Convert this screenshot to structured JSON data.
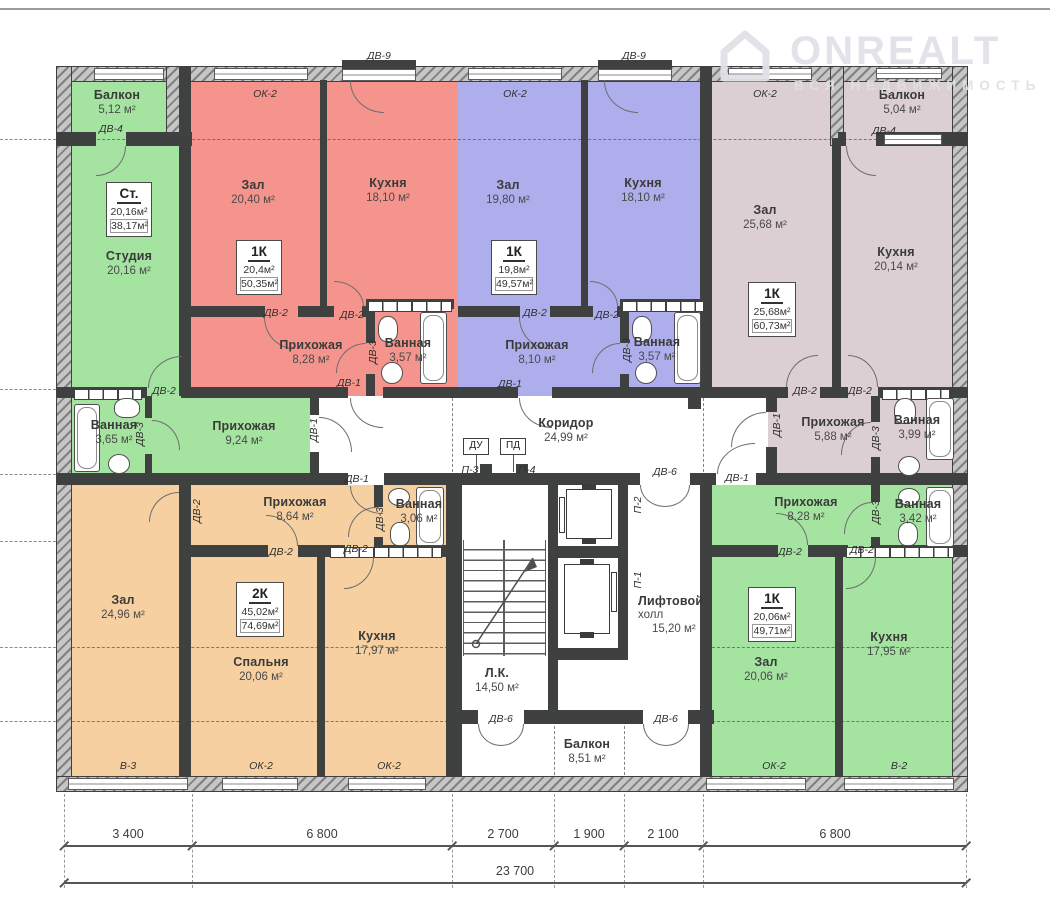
{
  "watermark": {
    "brand": "ONREALT",
    "tagline": "ВСЯ НЕДВИЖИМОСТЬ"
  },
  "legend": {
    "dv1": "ДВ-1",
    "dv2": "ДВ-2",
    "dv3": "ДВ-3",
    "dv4": "ДВ-4",
    "dv6": "ДВ-6",
    "dv9": "ДВ-9",
    "ok2": "ОК-2",
    "v2": "В-2",
    "v3": "В-3",
    "p1": "П-1",
    "p2": "П-2",
    "p3": "П-3",
    "p4": "П-4",
    "du": "ДУ",
    "pd": "ПД"
  },
  "apartments": {
    "studio": {
      "badge": {
        "type": "Ст.",
        "living": "20,16м²",
        "total": "38,17м²"
      },
      "balcony": {
        "name": "Балкон",
        "area": "5,12 м²"
      },
      "main": {
        "name": "Студия",
        "area": "20,16 м²"
      },
      "hall": {
        "name": "Прихожая",
        "area": "9,24 м²"
      },
      "bath": {
        "name": "Ванная",
        "area": "3,65 м²"
      }
    },
    "red1k": {
      "badge": {
        "type": "1К",
        "living": "20,4м²",
        "total": "50,35м²"
      },
      "zal": {
        "name": "Зал",
        "area": "20,40 м²"
      },
      "kitchen": {
        "name": "Кухня",
        "area": "18,10 м²"
      },
      "hall": {
        "name": "Прихожая",
        "area": "8,28 м²"
      },
      "bath": {
        "name": "Ванная",
        "area": "3,57 м²"
      }
    },
    "blue1k": {
      "badge": {
        "type": "1К",
        "living": "19,8м²",
        "total": "49,57м²"
      },
      "zal": {
        "name": "Зал",
        "area": "19,80 м²"
      },
      "kitchen": {
        "name": "Кухня",
        "area": "18,10 м²"
      },
      "hall": {
        "name": "Прихожая",
        "area": "8,10 м²"
      },
      "bath": {
        "name": "Ванная",
        "area": "3,57 м²"
      }
    },
    "mauve1k": {
      "badge": {
        "type": "1К",
        "living": "25,68м²",
        "total": "60,73м²"
      },
      "balcony": {
        "name": "Балкон",
        "area": "5,04 м²"
      },
      "zal": {
        "name": "Зал",
        "area": "25,68 м²"
      },
      "kitchen": {
        "name": "Кухня",
        "area": "20,14 м²"
      },
      "hall": {
        "name": "Прихожая",
        "area": "5,88 м²"
      },
      "bath": {
        "name": "Ванная",
        "area": "3,99 м²"
      }
    },
    "orange2k": {
      "badge": {
        "type": "2К",
        "living": "45,02м²",
        "total": "74,69м²"
      },
      "zal": {
        "name": "Зал",
        "area": "24,96 м²"
      },
      "bedroom": {
        "name": "Спальня",
        "area": "20,06 м²"
      },
      "kitchen": {
        "name": "Кухня",
        "area": "17,97 м²"
      },
      "hall": {
        "name": "Прихожая",
        "area": "8,64 м²"
      },
      "bath": {
        "name": "Ванная",
        "area": "3,06 м²"
      }
    },
    "green1k": {
      "badge": {
        "type": "1К",
        "living": "20,06м²",
        "total": "49,71м²"
      },
      "zal": {
        "name": "Зал",
        "area": "20,06 м²"
      },
      "kitchen": {
        "name": "Кухня",
        "area": "17,95 м²"
      },
      "hall": {
        "name": "Прихожая",
        "area": "8,28 м²"
      },
      "bath": {
        "name": "Ванная",
        "area": "3,42 м²"
      }
    }
  },
  "common": {
    "corridor": {
      "name": "Коридор",
      "area": "24,99 м²"
    },
    "stairs": {
      "name": "Л.К.",
      "area": "14,50 м²"
    },
    "lift_hall": {
      "line1": "Лифтовой",
      "line2": "холл",
      "area": "15,20 м²"
    },
    "balcony": {
      "name": "Балкон",
      "area": "8,51 м²"
    }
  },
  "dimensions": {
    "segments": [
      "3 400",
      "6 800",
      "2 700",
      "1 900",
      "2 100",
      "6 800"
    ],
    "total": "23 700"
  },
  "colors": {
    "studio_green": "#a5e3a0",
    "red": "#f5948c",
    "blue": "#afaeec",
    "mauve": "#dccfd4",
    "orange": "#f7d0a1",
    "green": "#a5e3a0",
    "wall": "#3f4040",
    "accent_text": "#3a3a3a"
  }
}
